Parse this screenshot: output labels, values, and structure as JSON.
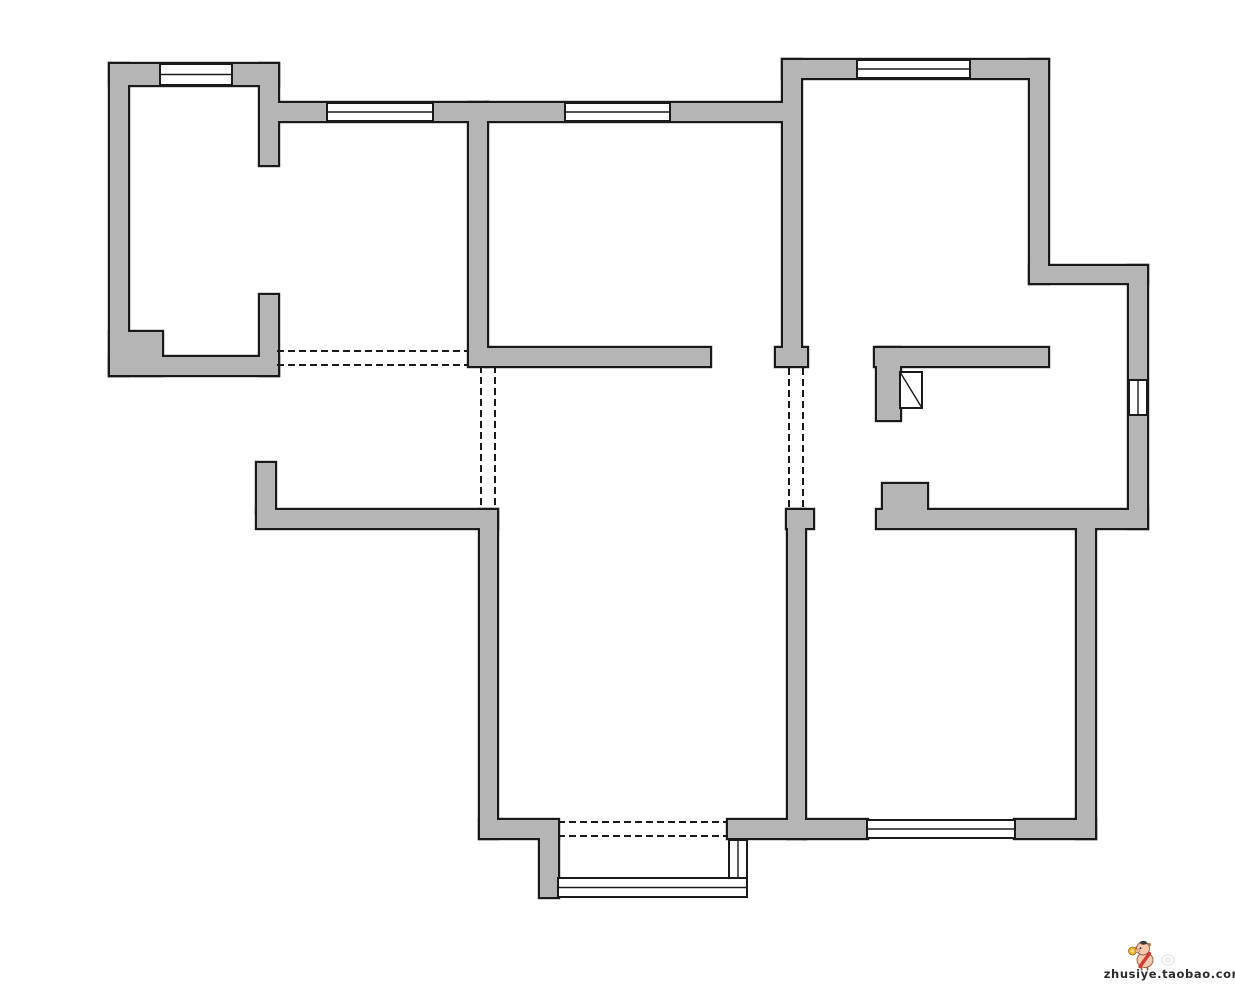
{
  "watermark": {
    "text": "zhusiye.taobao.com",
    "logo": "pig-mascot"
  },
  "palette": {
    "background": "#ffffff",
    "wall_fill": "#b5b5b5",
    "outline": "#1a1a1a",
    "window_fill": "#ffffff",
    "watermark_text_color": "#2b2b2b",
    "pig_body": "#f6c9ae",
    "pig_sash_red": "#cd3b33",
    "medal_yellow": "#f0b32c",
    "faint_stamp_gray": "#c9c9c9"
  },
  "floorplan": {
    "canvas": {
      "width": 1235,
      "height": 985
    },
    "style": {
      "outline_inflate": 2.2,
      "window_stroke": 2,
      "window_inner_stroke": 1.4,
      "dash_stroke": 2,
      "dash_pattern": "7 4"
    },
    "walls": [
      {
        "name": "bedroom1-left-wall",
        "x": 110,
        "y": 64,
        "w": 18,
        "h": 311
      },
      {
        "name": "bedroom1-top-wall",
        "x": 110,
        "y": 64,
        "w": 168,
        "h": 21
      },
      {
        "name": "bedroom1-right-wall-upper",
        "x": 260,
        "y": 64,
        "w": 18,
        "h": 101
      },
      {
        "name": "bedroom1-right-wall-lower",
        "x": 260,
        "y": 295,
        "w": 18,
        "h": 80
      },
      {
        "name": "bedroom1-bottom-wall",
        "x": 110,
        "y": 357,
        "w": 168,
        "h": 18
      },
      {
        "name": "bedroom1-corner-pier",
        "x": 110,
        "y": 332,
        "w": 52,
        "h": 43
      },
      {
        "name": "closet-top-wall",
        "x": 278,
        "y": 103,
        "w": 209,
        "h": 18
      },
      {
        "name": "bedroom2-left-wall",
        "x": 469,
        "y": 103,
        "w": 18,
        "h": 263
      },
      {
        "name": "bedroom2-top-wall",
        "x": 487,
        "y": 103,
        "w": 296,
        "h": 18
      },
      {
        "name": "bedroom2-bottom-wall",
        "x": 487,
        "y": 348,
        "w": 223,
        "h": 18
      },
      {
        "name": "bedroom2-bedroom3-divider",
        "x": 783,
        "y": 60,
        "w": 18,
        "h": 288
      },
      {
        "name": "divider-wall-foot",
        "x": 776,
        "y": 348,
        "w": 31,
        "h": 18
      },
      {
        "name": "bedroom3-top-wall",
        "x": 783,
        "y": 60,
        "w": 265,
        "h": 18
      },
      {
        "name": "bedroom3-right-wall",
        "x": 1030,
        "y": 60,
        "w": 18,
        "h": 223
      },
      {
        "name": "right-step-wall",
        "x": 1030,
        "y": 266,
        "w": 117,
        "h": 17
      },
      {
        "name": "right-outer-wall",
        "x": 1129,
        "y": 266,
        "w": 18,
        "h": 262
      },
      {
        "name": "bedroom3-bottom-wall",
        "x": 875,
        "y": 348,
        "w": 173,
        "h": 18
      },
      {
        "name": "bathroom-door-stub",
        "x": 877,
        "y": 348,
        "w": 23,
        "h": 72
      },
      {
        "name": "bathroom-door-block",
        "x": 883,
        "y": 484,
        "w": 44,
        "h": 28
      },
      {
        "name": "bathroom-bottom-wall",
        "x": 877,
        "y": 510,
        "w": 270,
        "h": 18
      },
      {
        "name": "entry-stub-wall",
        "x": 257,
        "y": 463,
        "w": 18,
        "h": 49
      },
      {
        "name": "lower-left-outer-wall",
        "x": 257,
        "y": 510,
        "w": 240,
        "h": 18
      },
      {
        "name": "livingroom-left-wall",
        "x": 480,
        "y": 510,
        "w": 17,
        "h": 328
      },
      {
        "name": "livingroom-bottom-wall-left",
        "x": 480,
        "y": 820,
        "w": 78,
        "h": 18
      },
      {
        "name": "balcony-left-wall",
        "x": 540,
        "y": 838,
        "w": 18,
        "h": 59
      },
      {
        "name": "livingroom-bottom-wall-right",
        "x": 728,
        "y": 820,
        "w": 77,
        "h": 18
      },
      {
        "name": "livingroom-bedroom4-foot",
        "x": 787,
        "y": 510,
        "w": 26,
        "h": 18
      },
      {
        "name": "livingroom-bedroom4-wall",
        "x": 788,
        "y": 510,
        "w": 17,
        "h": 328
      },
      {
        "name": "bedroom4-bottom-wall-left",
        "x": 805,
        "y": 820,
        "w": 62,
        "h": 18
      },
      {
        "name": "bedroom4-bottom-wall-right",
        "x": 1015,
        "y": 820,
        "w": 80,
        "h": 18
      },
      {
        "name": "bedroom4-right-wall",
        "x": 1077,
        "y": 512,
        "w": 18,
        "h": 326
      }
    ],
    "windows": [
      {
        "name": "bedroom1-window",
        "x": 160,
        "y": 64,
        "w": 72,
        "h": 21,
        "orient": "h"
      },
      {
        "name": "closet-window",
        "x": 327,
        "y": 103,
        "w": 106,
        "h": 18,
        "orient": "h"
      },
      {
        "name": "bedroom2-window",
        "x": 565,
        "y": 103,
        "w": 105,
        "h": 18,
        "orient": "h"
      },
      {
        "name": "bedroom3-window",
        "x": 857,
        "y": 60,
        "w": 113,
        "h": 18,
        "orient": "h"
      },
      {
        "name": "bathroom-window",
        "x": 1129,
        "y": 380,
        "w": 18,
        "h": 35,
        "orient": "v"
      },
      {
        "name": "bedroom4-window",
        "x": 867,
        "y": 820,
        "w": 148,
        "h": 18,
        "orient": "h"
      },
      {
        "name": "balcony-bottom-window",
        "x": 558,
        "y": 878,
        "w": 189,
        "h": 19,
        "orient": "h"
      },
      {
        "name": "balcony-right-window",
        "x": 729,
        "y": 840,
        "w": 18,
        "h": 38,
        "orient": "v"
      }
    ],
    "dashed_openings": [
      {
        "name": "foyer-opening-line-1",
        "x1": 277,
        "y1": 351,
        "x2": 469,
        "y2": 351
      },
      {
        "name": "foyer-opening-line-2",
        "x1": 277,
        "y1": 365,
        "x2": 469,
        "y2": 365
      },
      {
        "name": "dining-opening-line-1",
        "x1": 481,
        "y1": 366,
        "x2": 481,
        "y2": 510
      },
      {
        "name": "dining-opening-line-2",
        "x1": 495,
        "y1": 366,
        "x2": 495,
        "y2": 510
      },
      {
        "name": "hall-opening-line-1",
        "x1": 789,
        "y1": 368,
        "x2": 789,
        "y2": 508
      },
      {
        "name": "hall-opening-line-2",
        "x1": 803,
        "y1": 368,
        "x2": 803,
        "y2": 508
      },
      {
        "name": "balcony-opening-line-1",
        "x1": 558,
        "y1": 822,
        "x2": 728,
        "y2": 822
      },
      {
        "name": "balcony-opening-line-2",
        "x1": 558,
        "y1": 836,
        "x2": 728,
        "y2": 836
      }
    ],
    "flue": {
      "name": "flue-shaft",
      "x": 900,
      "y": 372,
      "w": 22,
      "h": 36
    }
  }
}
